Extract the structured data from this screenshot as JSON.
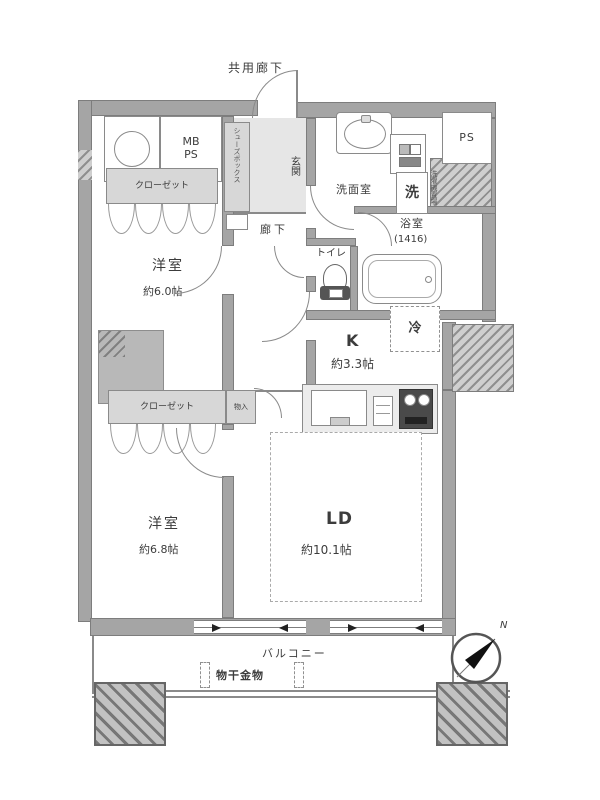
{
  "plan": {
    "common_corridor": "共用廊下",
    "entrance_label": "玄関",
    "shoe_cabinet_label": "シューズボックス",
    "hallway_label": "廊下",
    "mb_ps_label": "MB\nPS",
    "ps_label": "PS",
    "closet_front": "クローゼット",
    "closet_back": "クローゼット",
    "storage_label": "物入",
    "bedroom1": {
      "name": "洋室",
      "size": "約6.0帖"
    },
    "bedroom2": {
      "name": "洋室",
      "size": "約6.8帖"
    },
    "living_dining": {
      "name": "LD",
      "size": "約10.1帖"
    },
    "kitchen": {
      "name": "K",
      "size": "約3.3帖",
      "counter_label": "カウンター",
      "refrigerator_label": "冷"
    },
    "washroom_label": "洗面室",
    "laundry_label": "洗",
    "laundry_place_label": "洗濯機置場",
    "bathroom": {
      "name": "浴室",
      "size": "(1416)"
    },
    "toilet_label": "トイレ",
    "balcony_label": "バルコニー",
    "laundry_hardware_label": "物干金物",
    "compass_north": "N"
  },
  "colors": {
    "wall": "#a5a5a5",
    "wall_edge": "#7d7d7d",
    "line": "#8a8a8a",
    "text": "#3c3c3c",
    "closet_fill": "#d7d7d7",
    "hatch_fill": "#cfcfcf"
  }
}
